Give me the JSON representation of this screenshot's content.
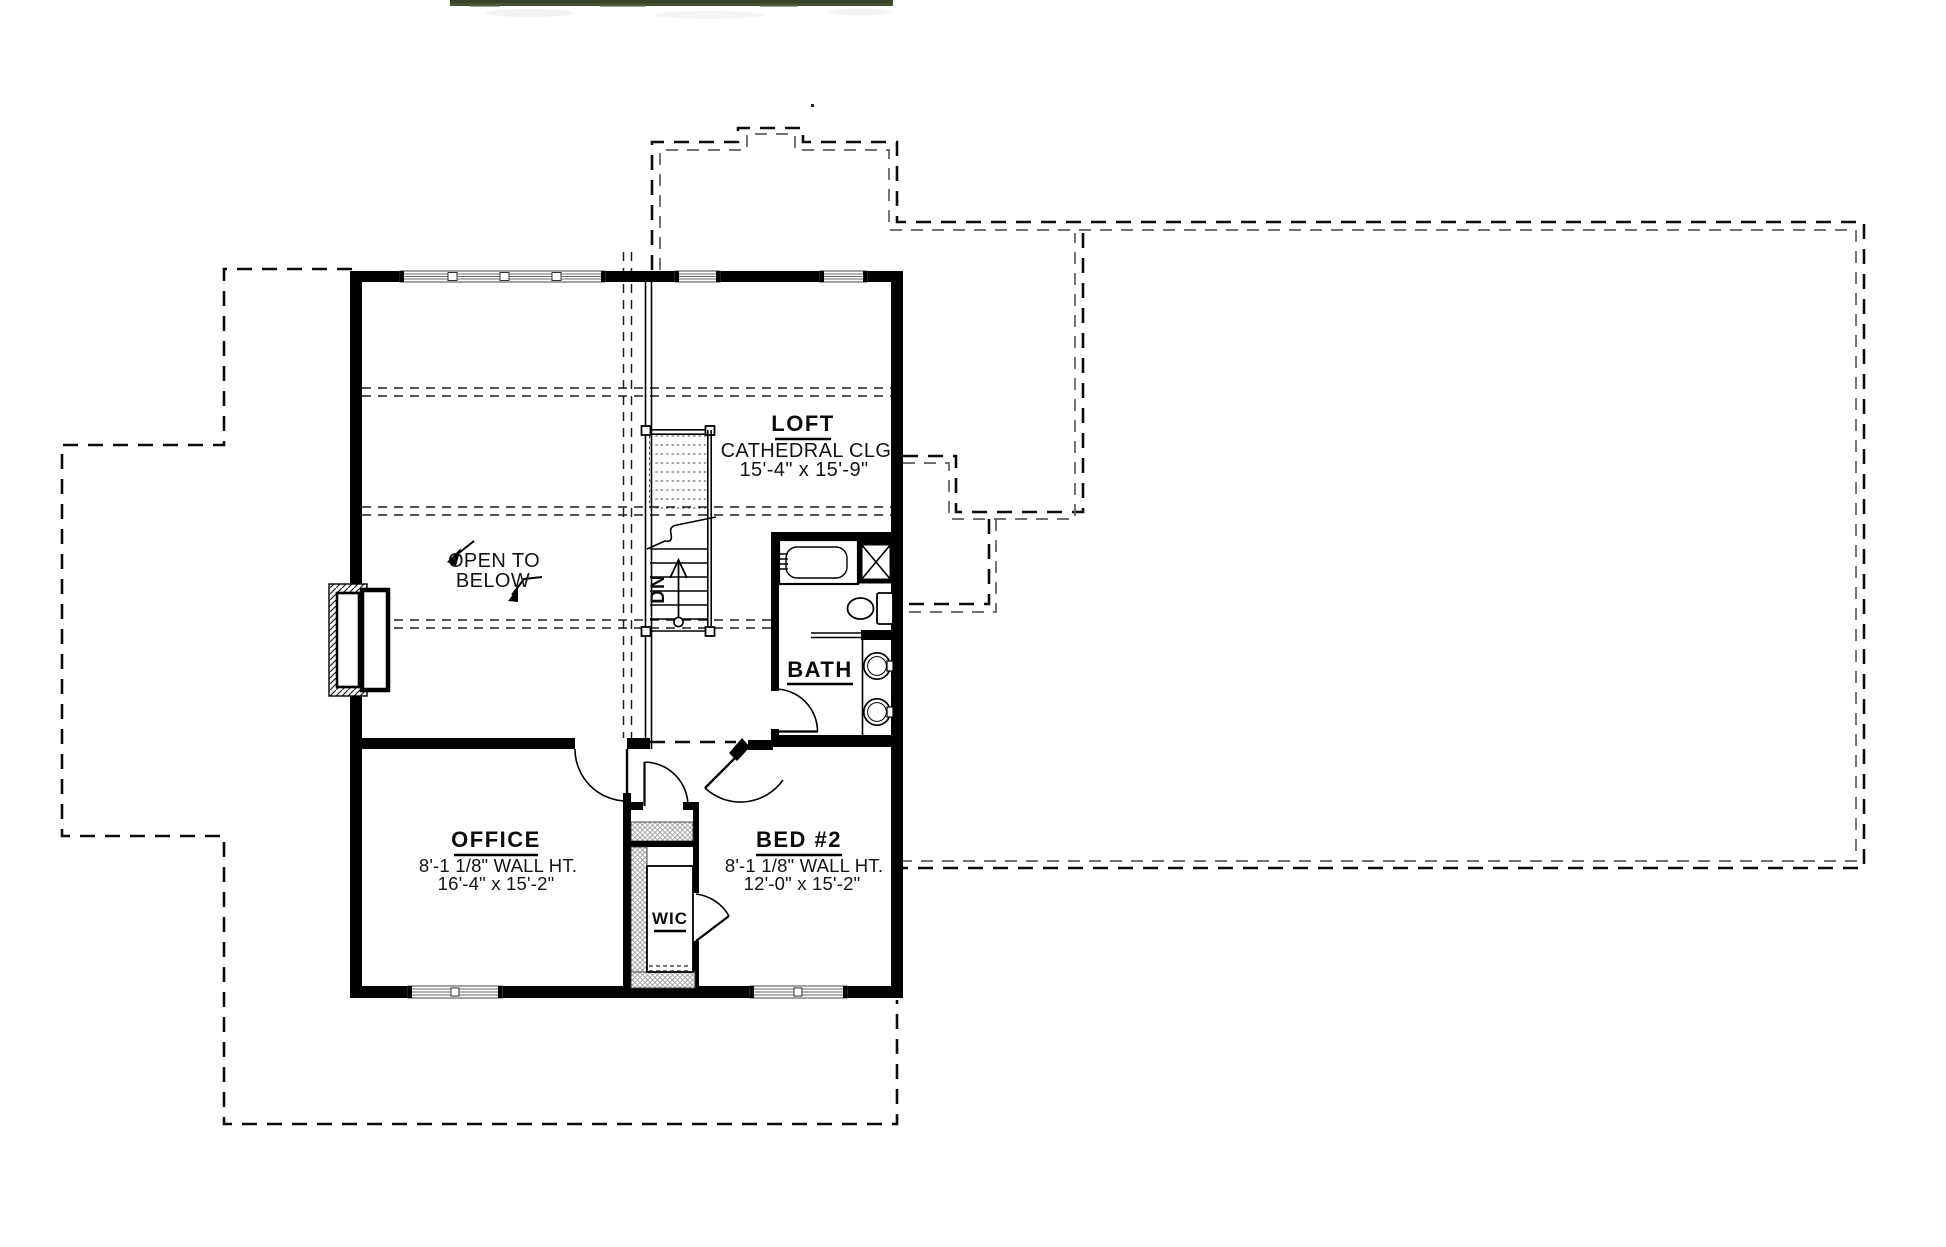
{
  "plan": {
    "loft": {
      "name": "LOFT",
      "ceiling": "CATHEDRAL CLG",
      "dims": "15'-4\" x 15'-9\""
    },
    "open_to_below": {
      "line1": "OPEN TO",
      "line2": "BELOW"
    },
    "stair": {
      "direction": "DN"
    },
    "bath": {
      "name": "BATH"
    },
    "office": {
      "name": "OFFICE",
      "wall_height": "8'-1 1/8\" WALL HT.",
      "dims": "16'-4\" x 15'-2\""
    },
    "bed2": {
      "name": "BED #2",
      "wall_height": "8'-1 1/8\" WALL HT.",
      "dims": "12'-0\" x 15'-2\""
    },
    "wic": {
      "name": "WIC"
    }
  },
  "colors": {
    "ink": "#000000",
    "paper": "#ffffff",
    "grass": "#42502e"
  }
}
